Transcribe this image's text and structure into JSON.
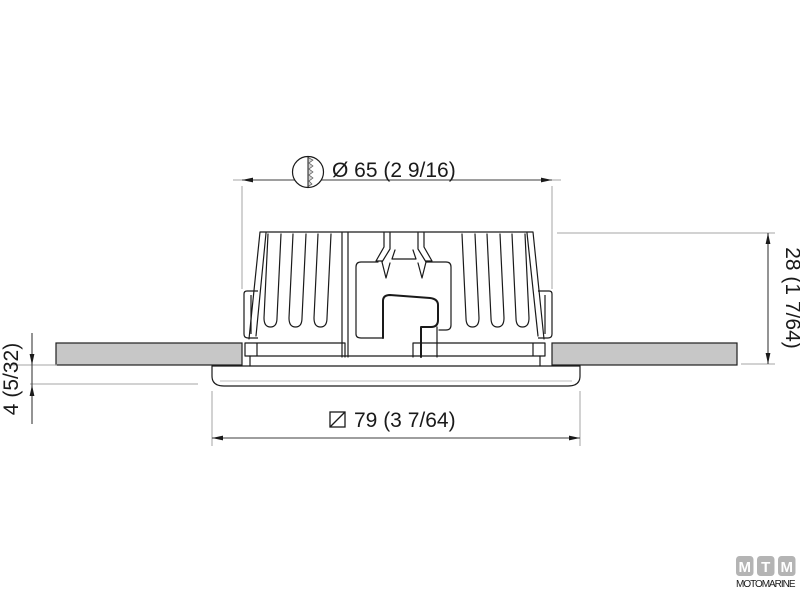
{
  "dimensions": {
    "hole_diameter": "Ø 65  (2 9/16)",
    "height": "28 (1 7/64)",
    "flange_protrusion": "4 (5/32)",
    "flange_width": "79  (3 7/64)"
  },
  "logo": {
    "blocks": [
      "M",
      "T",
      "M"
    ],
    "wordmark": "MOTOMARINE"
  },
  "colors": {
    "line": "#1a1a1a",
    "dim_line": "#3c3c3c",
    "extension_line": "#a6a6a6",
    "panel_fill": "#c7c7c7",
    "screw_fill": "#d2d2d2",
    "logo_gray": "#b4b4b4"
  }
}
